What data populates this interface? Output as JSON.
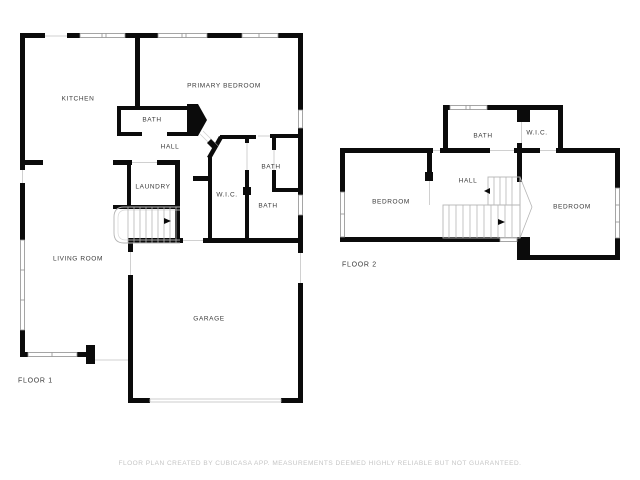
{
  "colors": {
    "wall": "#0b0b0b",
    "window_stroke": "#8f8f8f",
    "door_line": "#d0d0d0",
    "stair_line": "#b5b5b5",
    "room_label": "#3a3a3a",
    "disclaimer": "#c5c5c5",
    "background": "#ffffff"
  },
  "floor1": {
    "label": "FLOOR 1",
    "rooms": {
      "kitchen": "KITCHEN",
      "primary_bedroom": "PRIMARY BEDROOM",
      "bath_center": "BATH",
      "hall": "HALL",
      "laundry": "LAUNDRY",
      "wic": "W.I.C.",
      "bath_upper_right": "BATH",
      "bath_lower_right": "BATH",
      "living_room": "LIVING ROOM",
      "garage": "GARAGE"
    }
  },
  "floor2": {
    "label": "FLOOR 2",
    "rooms": {
      "bath": "BATH",
      "wic": "W.I.C.",
      "hall": "HALL",
      "bedroom_left": "BEDROOM",
      "bedroom_right": "BEDROOM"
    }
  },
  "disclaimer": "FLOOR PLAN CREATED BY CUBICASA APP. MEASUREMENTS DEEMED HIGHLY RELIABLE BUT NOT GUARANTEED."
}
